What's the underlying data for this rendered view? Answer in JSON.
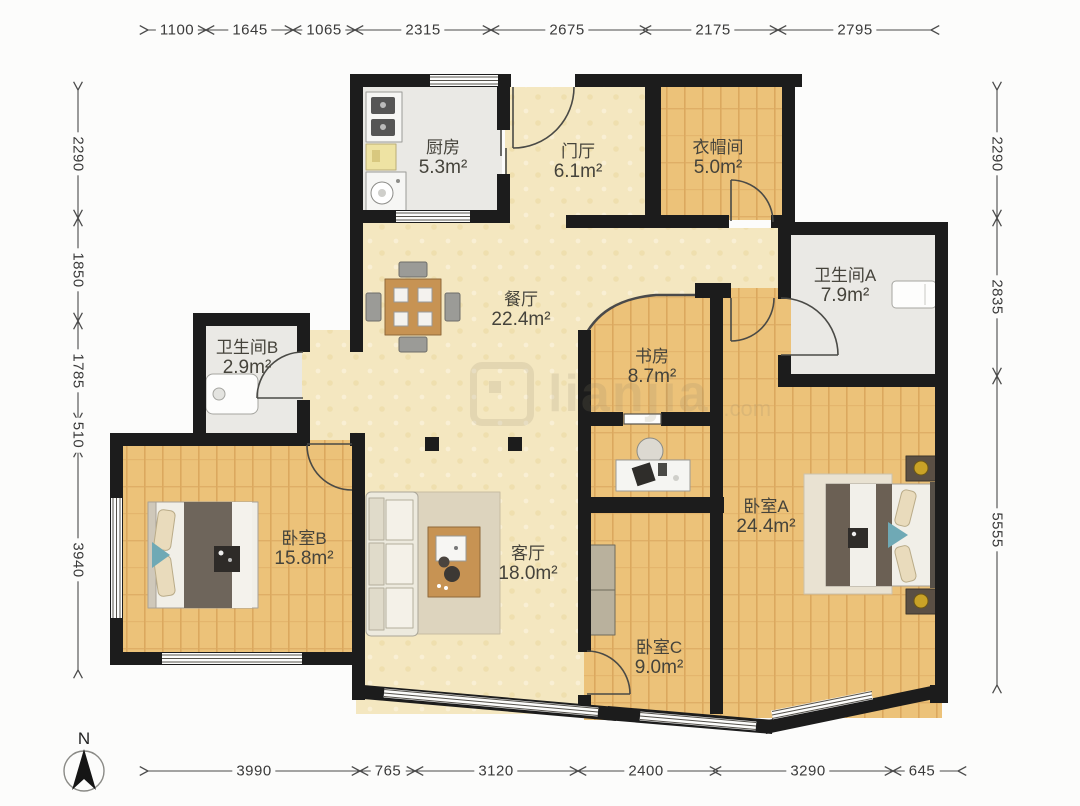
{
  "compass": {
    "label": "N"
  },
  "watermark": {
    "text": "lianjia",
    "suffix": ".com"
  },
  "rooms": {
    "kitchen": {
      "name": "厨房",
      "area": "5.3m²"
    },
    "foyer": {
      "name": "门厅",
      "area": "6.1m²"
    },
    "cloakroom": {
      "name": "衣帽间",
      "area": "5.0m²"
    },
    "bathroom_a": {
      "name": "卫生间A",
      "area": "7.9m²"
    },
    "bathroom_b": {
      "name": "卫生间B",
      "area": "2.9m²"
    },
    "dining": {
      "name": "餐厅",
      "area": "22.4m²"
    },
    "study": {
      "name": "书房",
      "area": "8.7m²"
    },
    "bedroom_a": {
      "name": "卧室A",
      "area": "24.4m²"
    },
    "bedroom_b": {
      "name": "卧室B",
      "area": "15.8m²"
    },
    "living": {
      "name": "客厅",
      "area": "18.0m²"
    },
    "bedroom_c": {
      "name": "卧室C",
      "area": "9.0m²"
    }
  },
  "dimensions_mm": {
    "top": [
      "1100",
      "1645",
      "1065",
      "2315",
      "2675",
      "2175",
      "2795"
    ],
    "left": [
      "2290",
      "1850",
      "1785",
      "510",
      "3940"
    ],
    "right": [
      "2290",
      "2835",
      "5555"
    ],
    "bottom": [
      "3990",
      "765",
      "3120",
      "2400",
      "3290",
      "645"
    ]
  },
  "colors": {
    "wall": "#1c1c1c",
    "wood_floor": "#ecc279",
    "beige_floor": "#f4e7c0",
    "tile_floor": "#eae9e5",
    "dim_text": "#3a3a3a"
  }
}
